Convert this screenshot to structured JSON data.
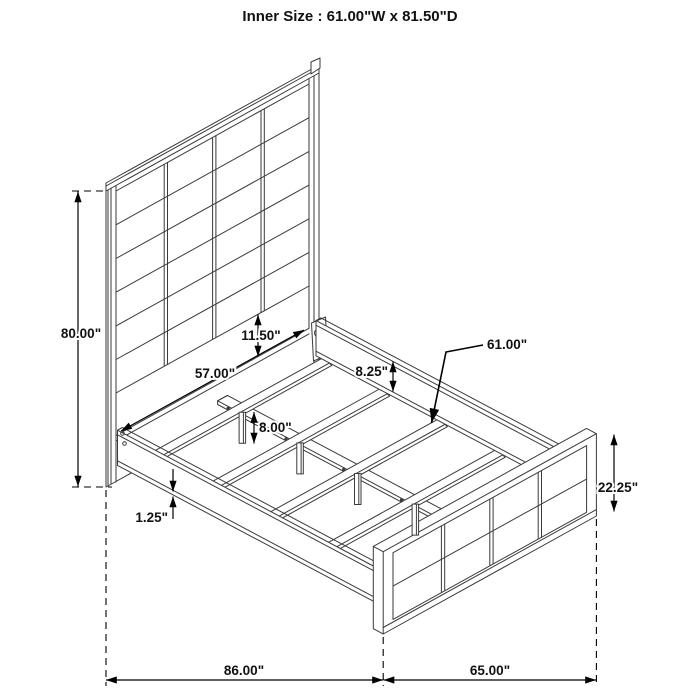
{
  "title": "Inner Size : 61.00\"W x 81.50\"D",
  "dimensions": {
    "headboard_height": "80.00\"",
    "inner_width_at_headboard": "57.00\"",
    "headboard_bottom_rail_height": "11.50\"",
    "side_rail_height": "8.25\"",
    "slat_length": "61.00\"",
    "center_leg_height": "8.00\"",
    "side_rail_lip": "1.25\"",
    "footboard_height": "22.25\"",
    "overall_depth": "86.00\"",
    "overall_width": "65.00\""
  }
}
